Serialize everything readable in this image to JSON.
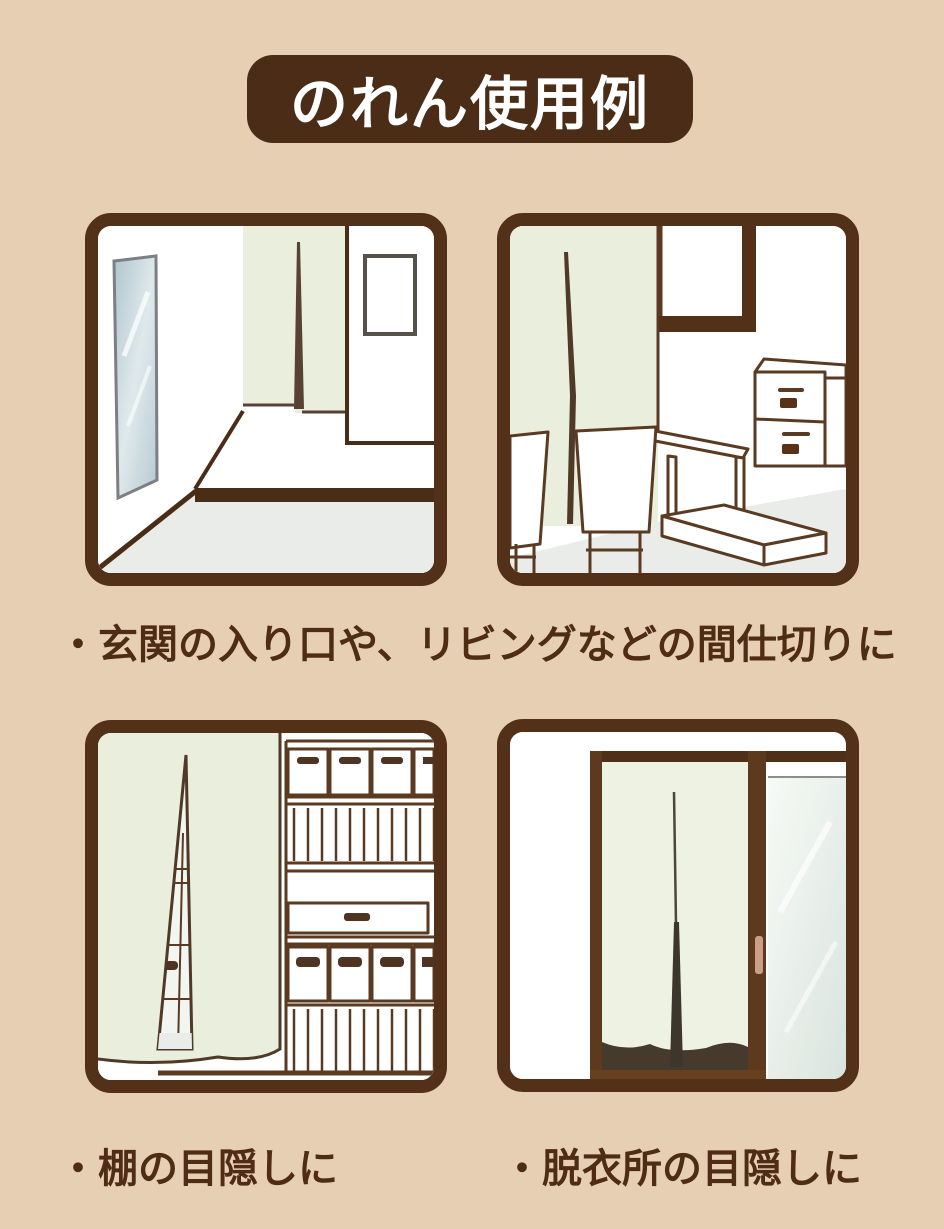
{
  "page": {
    "background": "#e7cfb4"
  },
  "title": {
    "label": "のれん使用例",
    "bg": "#4b2d17",
    "text_color": "#ffffff"
  },
  "captions": [
    {
      "id": "partition",
      "text": "・玄関の入り口や、リビングなどの間仕切りに"
    },
    {
      "id": "shelf",
      "text": "・棚の目隠しに"
    },
    {
      "id": "dressing",
      "text": "・脱衣所の目隠しに"
    }
  ],
  "panels": [
    {
      "name": "entrance-hallway-noren-illustration"
    },
    {
      "name": "living-room-noren-illustration"
    },
    {
      "name": "shelf-cover-noren-illustration"
    },
    {
      "name": "dressing-room-doorway-noren-illustration"
    }
  ],
  "colors": {
    "panel_border": "#533018",
    "title_bg": "#4b2d17",
    "caption_text": "#4f2d15",
    "noren_fabric": "#e9eedd",
    "noren_fabric_light": "#eef2e2",
    "floor": "#e9ece8",
    "outline": "#5a3b22",
    "dark_line": "#4a2d16",
    "shadow": "#453a2c",
    "glass": "#dde7e1",
    "handle": "#c9a084"
  }
}
